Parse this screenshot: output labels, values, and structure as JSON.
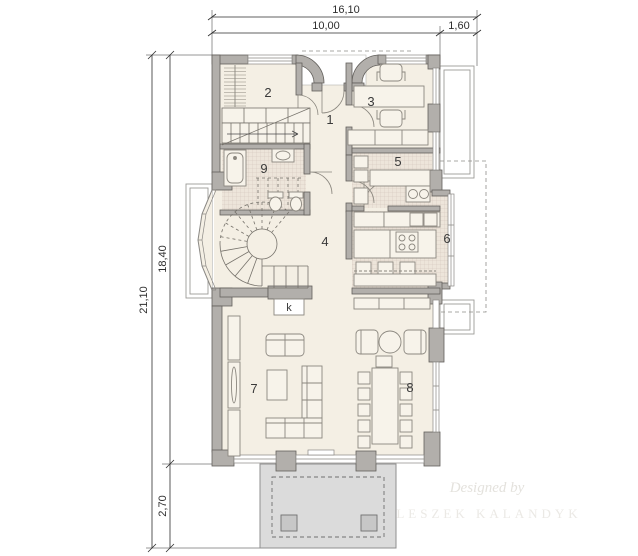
{
  "plan": {
    "dimensions": {
      "top_total": "16,10",
      "top_left": "10,00",
      "top_right": "1,60",
      "side_total": "21,10",
      "side_main": "18,40",
      "side_bottom": "2,70"
    },
    "room_labels": {
      "r1": "1",
      "r2": "2",
      "r3": "3",
      "r4": "4",
      "r5": "5",
      "r6": "6",
      "r7": "7",
      "r8": "8",
      "r9": "9",
      "fireplace": "k"
    },
    "watermark": {
      "line1": "Designed by",
      "line2": "LESZEK KALANDYK"
    },
    "colors": {
      "wall": "#b2afab",
      "floor": "#f4efe4",
      "tile_base": "#ede5da",
      "terrace": "#dbdbdb"
    }
  }
}
